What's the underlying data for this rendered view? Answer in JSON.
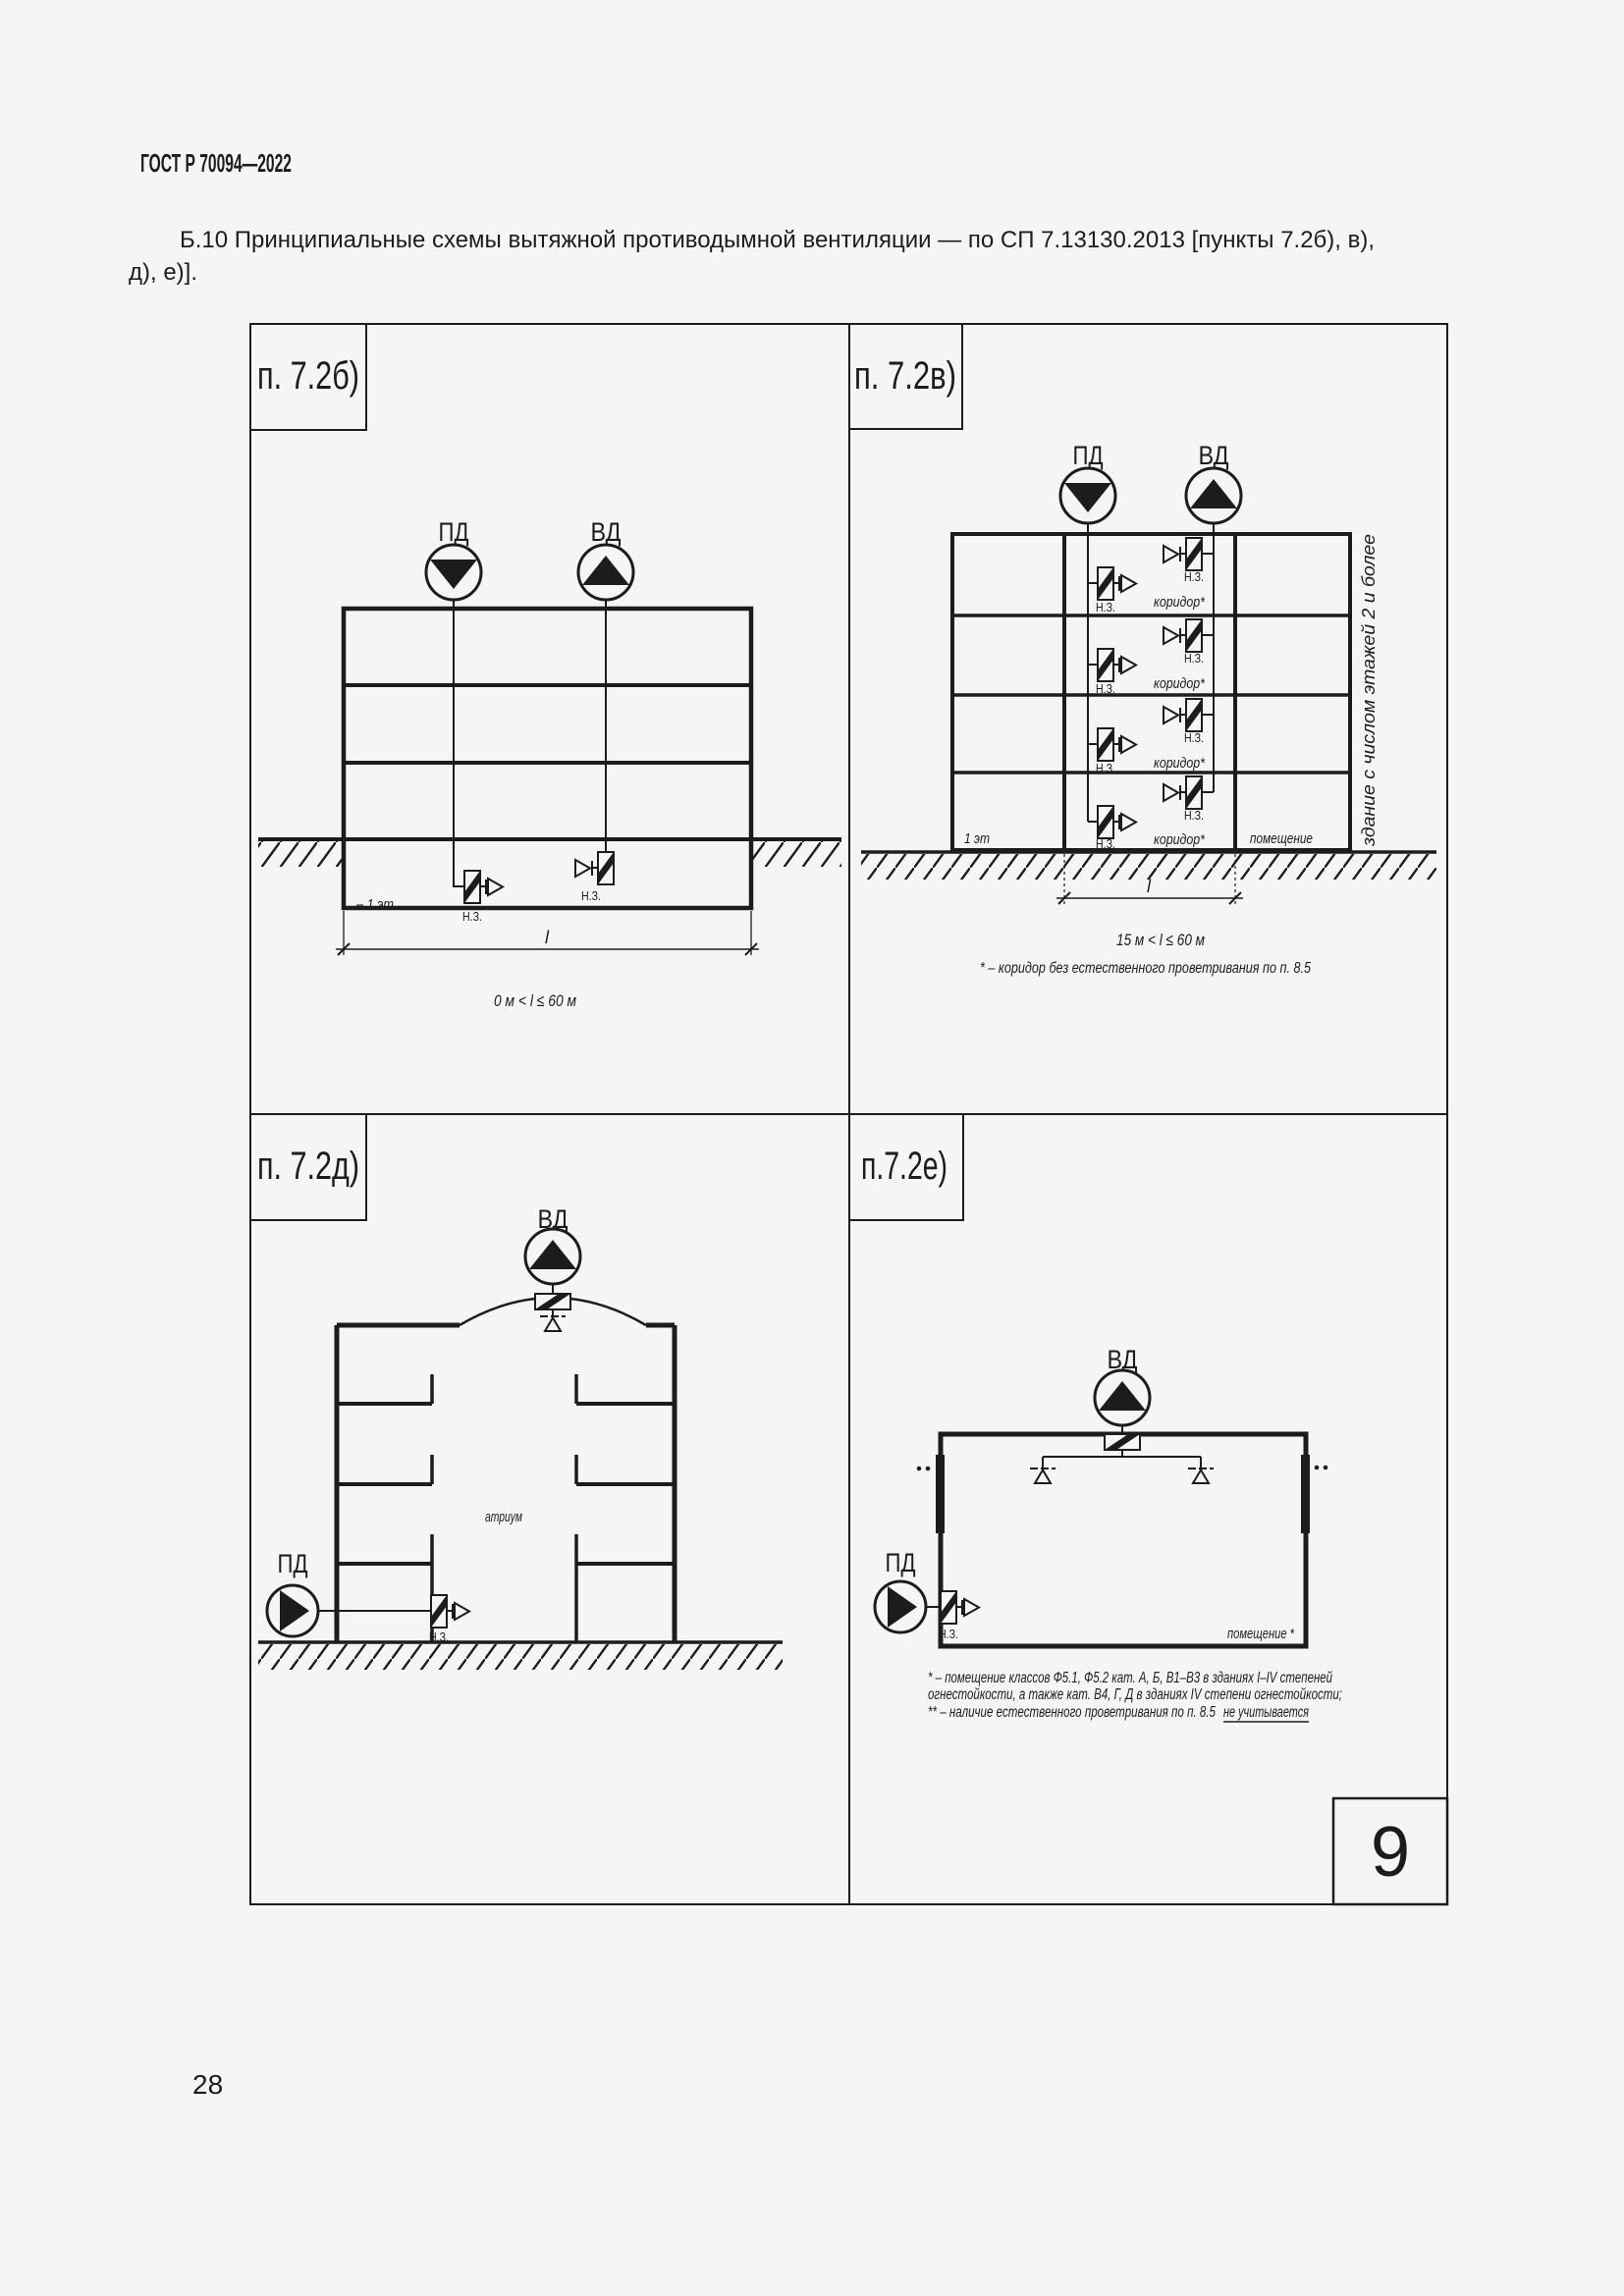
{
  "page": {
    "header": "ГОСТ Р 70094—2022",
    "paragraph_line1": "Б.10 Принципиальные схемы вытяжной противодымной вентиляции — по СП 7.13130.2013 [пункты 7.2б), в),",
    "paragraph_line2": "д), е)].",
    "page_number": "28"
  },
  "figure": {
    "sheet_number": "9"
  },
  "icons": {
    "supply_fan": "circle-with-solid-triangle (supply smoke fan)",
    "exhaust_fan": "circle-with-solid-triangle-up (exhaust smoke fan)",
    "fire_damper": "rect-with-diagonal-band (normally closed damper)",
    "smoke_intake": "open-triangle-under-tick (smoke intake opening)"
  },
  "labels": {
    "pd": "ПД",
    "vd": "ВД",
    "nz": "Н.З.",
    "corridor": "коридор*",
    "room": "помещение",
    "room_star": "помещение *",
    "first_floor": "1 эт",
    "basement_floor": "– 1 эт",
    "atrium": "атриум",
    "dim": "l"
  },
  "panels": {
    "b": {
      "title": "п. 7.2б)",
      "caption": "0 м < l ≤ 60 м"
    },
    "v": {
      "title": "п. 7.2в)",
      "caption": "15 м < l ≤ 60 м",
      "footnote": "* – коридор без естественного проветривания по п. 8.5",
      "side_note": "здание с числом этажей 2 и более"
    },
    "d": {
      "title": "п. 7.2д)"
    },
    "e": {
      "title": "п.7.2е)",
      "footnote_line1": "* – помещение классов Ф5.1, Ф5.2 кат. А, Б, В1–В3 в зданиях I–IV степеней",
      "footnote_line2": "огнестойкости, а также кат. В4, Г, Д в зданиях IV степени огнестойкости;",
      "footnote_line3_prefix": "** – наличие естественного проветривания по п. 8.5",
      "footnote_line3_underlined": "не учитывается"
    }
  }
}
